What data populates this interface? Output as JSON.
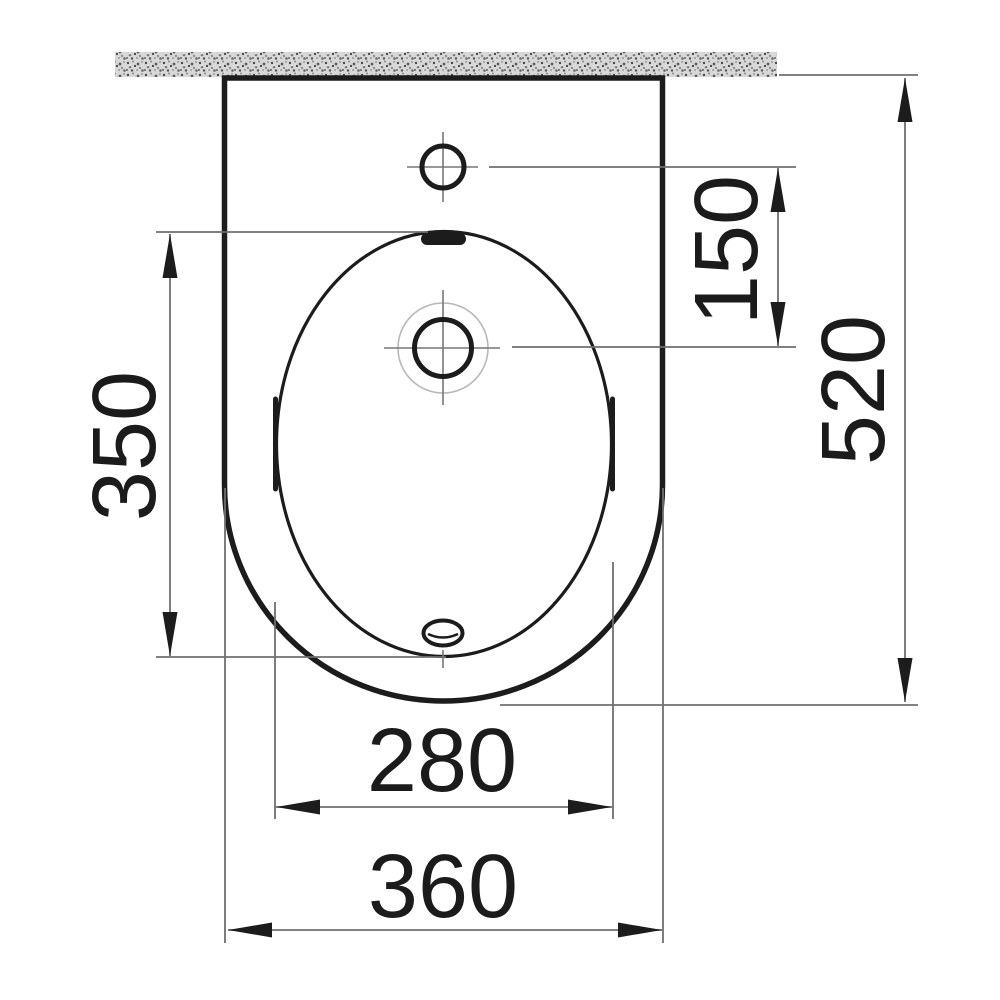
{
  "drawing": {
    "title": "Bidet technical dimension drawing, top view",
    "units": "mm",
    "colors": {
      "line_bold": "#1c1c1c",
      "line_thin": "#6f6f6f",
      "line_faint": "#b8b8b8",
      "wall_fill": "#d8d8d8",
      "background": "#ffffff"
    },
    "dimensions": [
      {
        "id": "faucet-to-spray-distance",
        "label": "150",
        "orientation": "vertical"
      },
      {
        "id": "overall-depth",
        "label": "520",
        "orientation": "vertical"
      },
      {
        "id": "basin-depth",
        "label": "350",
        "orientation": "vertical"
      },
      {
        "id": "basin-width",
        "label": "280",
        "orientation": "horizontal"
      },
      {
        "id": "overall-width",
        "label": "360",
        "orientation": "horizontal"
      }
    ]
  }
}
